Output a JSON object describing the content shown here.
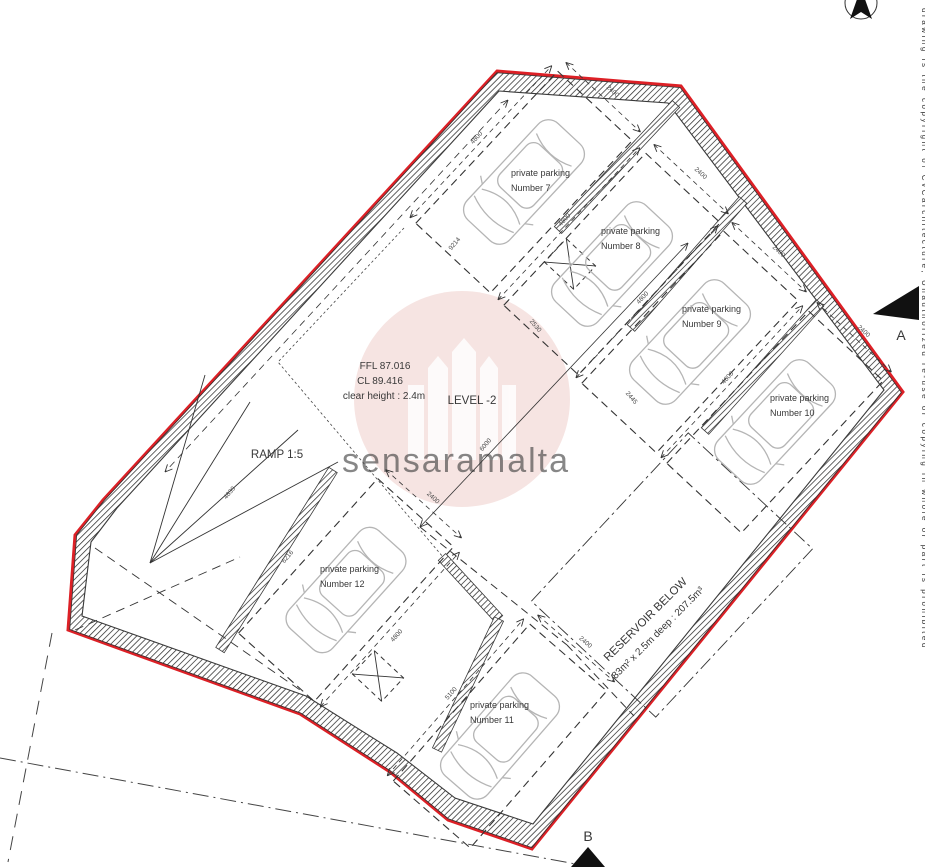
{
  "title": "Basement parking level plan",
  "level": {
    "name": "LEVEL -2",
    "ffl": "FFL 87.016",
    "cl": "CL 89.416",
    "clear_height": "clear height : 2.4m"
  },
  "ramp": {
    "label": "RAMP 1:5"
  },
  "reservoir": {
    "line1": "RESERVOIR BELOW",
    "line2": "83m² x 2.5m deep : 207.5m³"
  },
  "stalls": [
    {
      "id": "7",
      "line1": "private parking",
      "line2": "Number 7",
      "cx": 524,
      "cy": 182,
      "angle": -47,
      "dim_head": "2400",
      "dim_side": "4800",
      "side": -1,
      "lx": 511,
      "ly": 176
    },
    {
      "id": "8",
      "line1": "private parking",
      "line2": "Number 8",
      "cx": 612,
      "cy": 264,
      "angle": -47,
      "dim_head": "2400",
      "dim_side": "4800",
      "side": -1,
      "lx": 601,
      "ly": 234
    },
    {
      "id": "9",
      "line1": "private parking",
      "line2": "Number 9",
      "cx": 690,
      "cy": 342,
      "angle": -47,
      "dim_head": "2400",
      "dim_side": "4800",
      "side": -1,
      "lx": 682,
      "ly": 312
    },
    {
      "id": "10",
      "line1": "private parking",
      "line2": "Number 10",
      "cx": 775,
      "cy": 422,
      "angle": -47,
      "dim_head": "2400",
      "dim_side": "4800",
      "side": -1,
      "lx": 770,
      "ly": 401
    },
    {
      "id": "12",
      "line1": "private parking",
      "line2": "Number 12",
      "cx": 346,
      "cy": 590,
      "angle": -48,
      "dim_head": "2400",
      "dim_side": "4800",
      "side": 1,
      "lx": 320,
      "ly": 572
    },
    {
      "id": "11",
      "line1": "private parking",
      "line2": "Number 11",
      "cx": 500,
      "cy": 736,
      "angle": -49,
      "dim_head": "2400",
      "dim_side": "5100",
      "side": -1,
      "lx": 470,
      "ly": 708
    }
  ],
  "dimensions": [
    {
      "label": "9214",
      "x": 456,
      "y": 245,
      "rot": -50
    },
    {
      "label": "6000",
      "x": 487,
      "y": 446,
      "rot": -50
    },
    {
      "label": "6216",
      "x": 289,
      "y": 558,
      "rot": -50
    },
    {
      "label": "4839",
      "x": 231,
      "y": 494,
      "rot": -50
    },
    {
      "label": "2530",
      "x": 534,
      "y": 327,
      "rot": 50
    },
    {
      "label": "2445",
      "x": 630,
      "y": 399,
      "rot": 50
    }
  ],
  "section_markers": {
    "a": "A",
    "b": "B"
  },
  "watermark": {
    "text": "sensaramalta"
  },
  "copyright": "drawing is the copyright of CvCarchitecture, Unauthorized re-use or copying in whole or part is prohibited",
  "colors": {
    "boundary_red": "#dd2026",
    "wall_line": "#3a3a3a",
    "car_line": "#b5b5b5",
    "watermark_pink": "#c9544b",
    "dim_text": "#4a4a4a"
  }
}
